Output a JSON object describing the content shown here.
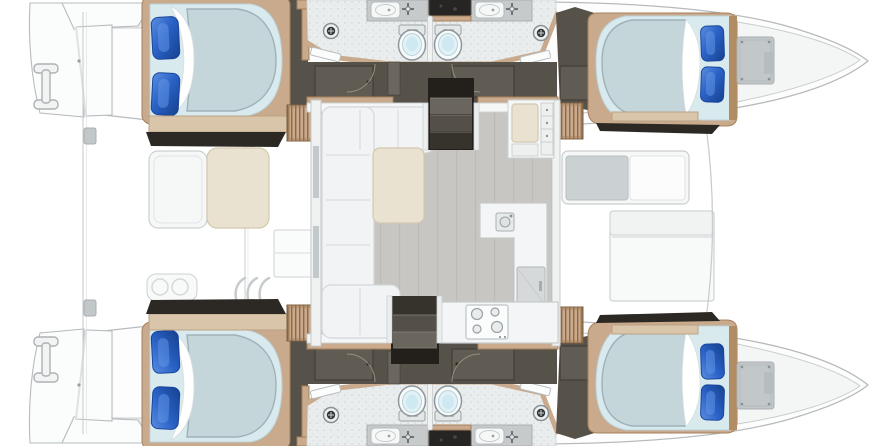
{
  "diagram": {
    "type": "catamaran-yacht-deck-plan",
    "orientation": "bow-right-stern-left",
    "inventory": {
      "double_berth_cabins": 4,
      "pillows_per_bed": 2,
      "heads_toilets": 4,
      "sink_vanities": 4,
      "shower_drains": 4,
      "louvered_wardrobes": 4,
      "companionway_stairs": 2,
      "salon_sofa": 1,
      "salon_table": 1,
      "nav_station": 1,
      "galley_sink": 1,
      "stove_burners": 4,
      "refrigerator": 1,
      "aft_cockpit_table": 1,
      "forward_cockpit_bench": 1,
      "forward_cockpit_table": 1,
      "forepeak_hatches": 2,
      "transom_platforms": 2,
      "transom_cleats": 2
    }
  },
  "colors": {
    "bg": "#ffffff",
    "hullStroke": "#b7bbbe",
    "deckLine": "#c9cdcf",
    "wood": "#c9aa8c",
    "woodDark": "#a5805c",
    "benchTan": "#d8c5aa",
    "benchLine": "#bba286",
    "floorDark": "#575249",
    "panelDark": "#615c53",
    "nearBlack": "#2c2823",
    "step1": "#6a655d",
    "step2": "#544f48",
    "step3": "#36322c",
    "salonFloor": "#c7c6c2",
    "plankLine": "#bcbbb7",
    "wallWhite": "#f5f6f6",
    "sofa": "#f1f3f4",
    "sofaLine": "#d4d8da",
    "beige": "#eae2d1",
    "beigeLine": "#d3c8b0",
    "bathFloor": "#eaeded",
    "vanity": "#c6cacb",
    "basin": "#f6f8f8",
    "fixtureLine": "#8e979b",
    "grayPanel": "#c2c7ca",
    "mattress": "#d9eaee",
    "duvet": "#c5d6da",
    "duvetLine": "#9db2b8",
    "pillowBlue": "#2a62c4",
    "pillowDark": "#1a459b",
    "toiletWater": "#cfe9f2",
    "drainDark": "#34383b"
  }
}
